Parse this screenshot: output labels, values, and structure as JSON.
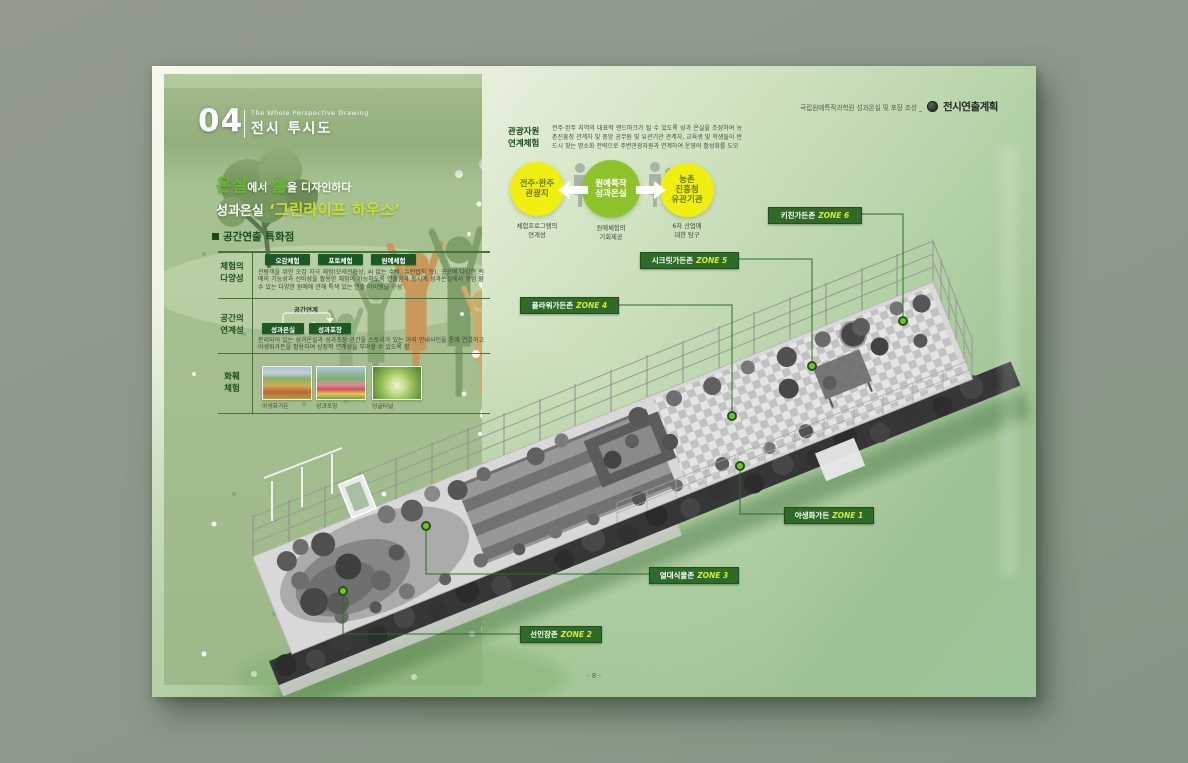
{
  "doc_header": {
    "project": "국립원예특작과학원 성과온실 및 포장 조성 _",
    "logo_icon": "circle-emblem-icon",
    "doc_title": "전시연출계획"
  },
  "chapter": {
    "number": "04",
    "subtitle_en": "The Whole Perspective Drawing",
    "title": "전시 투시도"
  },
  "headline": {
    "accent1": "온실",
    "normal1": "에서 ",
    "accent2": "삶",
    "normal2": "을 디자인하다",
    "line2_label": "성과온실",
    "line2_title": "‘그린라이프 하우스’"
  },
  "features": {
    "title": "공간연출 특화점",
    "rows": [
      {
        "label": "체험의\n다양성",
        "tags": [
          "오감체험",
          "포토체험",
          "원예체험"
        ],
        "desc": "관람객을 위한 오감 자극 체험(모세관현상, 씨 없는 수박, 뉴턴법칙 등), 곳곳에 다양한 원예의 기능성과 신비성을 활용한 체험이 가능하도록 연출함과 동시에 성과온실에서 경험 할 수 있는 다양한 원예에 관해 특색 있는 연출 아이템을 구성"
      },
      {
        "label": "공간의\n연계성",
        "link_label": "공간연계",
        "tags": [
          "성과온실",
          "성과포장"
        ],
        "desc": "분리되어 있는 성과온실과 성과포장 공간을 스토리가 있는 야외 안내사인을 통해 연결하고 야생화가든을 활용하여 상징적 연계성을 부여할 수 있도록 함"
      },
      {
        "label": "화훼\n체험",
        "photos": [
          {
            "caption": "야생화가든"
          },
          {
            "caption": "성과포장"
          },
          {
            "caption": "덩굴터널"
          }
        ]
      }
    ]
  },
  "tourism": {
    "label": "관광자원\n연계체험",
    "desc": "전주·완주 지역의 대표적 랜드마크가 될 수 있도록 성과 온실을 조성하여 농촌진흥청 관계자 및 중앙 공무원 및 유관기관 관계자, 교육생 및 학생들이 반드시 찾는 명소화 전략으로 주변관광자원과 연계하여 운영의 활성화를 도모",
    "circles": [
      {
        "title": "전주·완주\n관광지",
        "caption": "체험프로그램의\n연계성",
        "color": "#f0ef10"
      },
      {
        "title": "원예특작\n성과온실",
        "caption": "원예체험의\n기회제공",
        "color": "#8fc32c"
      },
      {
        "title": "농촌\n진흥청\n유관기관",
        "caption": "6차 산업에\n대한 탐구",
        "color": "#f0ef10"
      }
    ]
  },
  "zones": [
    {
      "name": "키친가든존",
      "code": "ZONE 6"
    },
    {
      "name": "시크릿가든존",
      "code": "ZONE 5"
    },
    {
      "name": "플라워가든존",
      "code": "ZONE 4"
    },
    {
      "name": "야생화가든",
      "code": "ZONE 1"
    },
    {
      "name": "열대식물존",
      "code": "ZONE 3"
    },
    {
      "name": "선인장존",
      "code": "ZONE 2"
    }
  ],
  "footer": {
    "page_number": "- 8 -"
  },
  "colors": {
    "accent_green": "#62bd27",
    "accent_yellowgreen": "#c6e033",
    "zone_box_green": "#2e6b28",
    "zone_code_yellow": "#d7ec2b",
    "circle_yellow": "#f0ef10",
    "circle_green": "#8fc32c",
    "dark_green_text": "#1c4a1b"
  }
}
